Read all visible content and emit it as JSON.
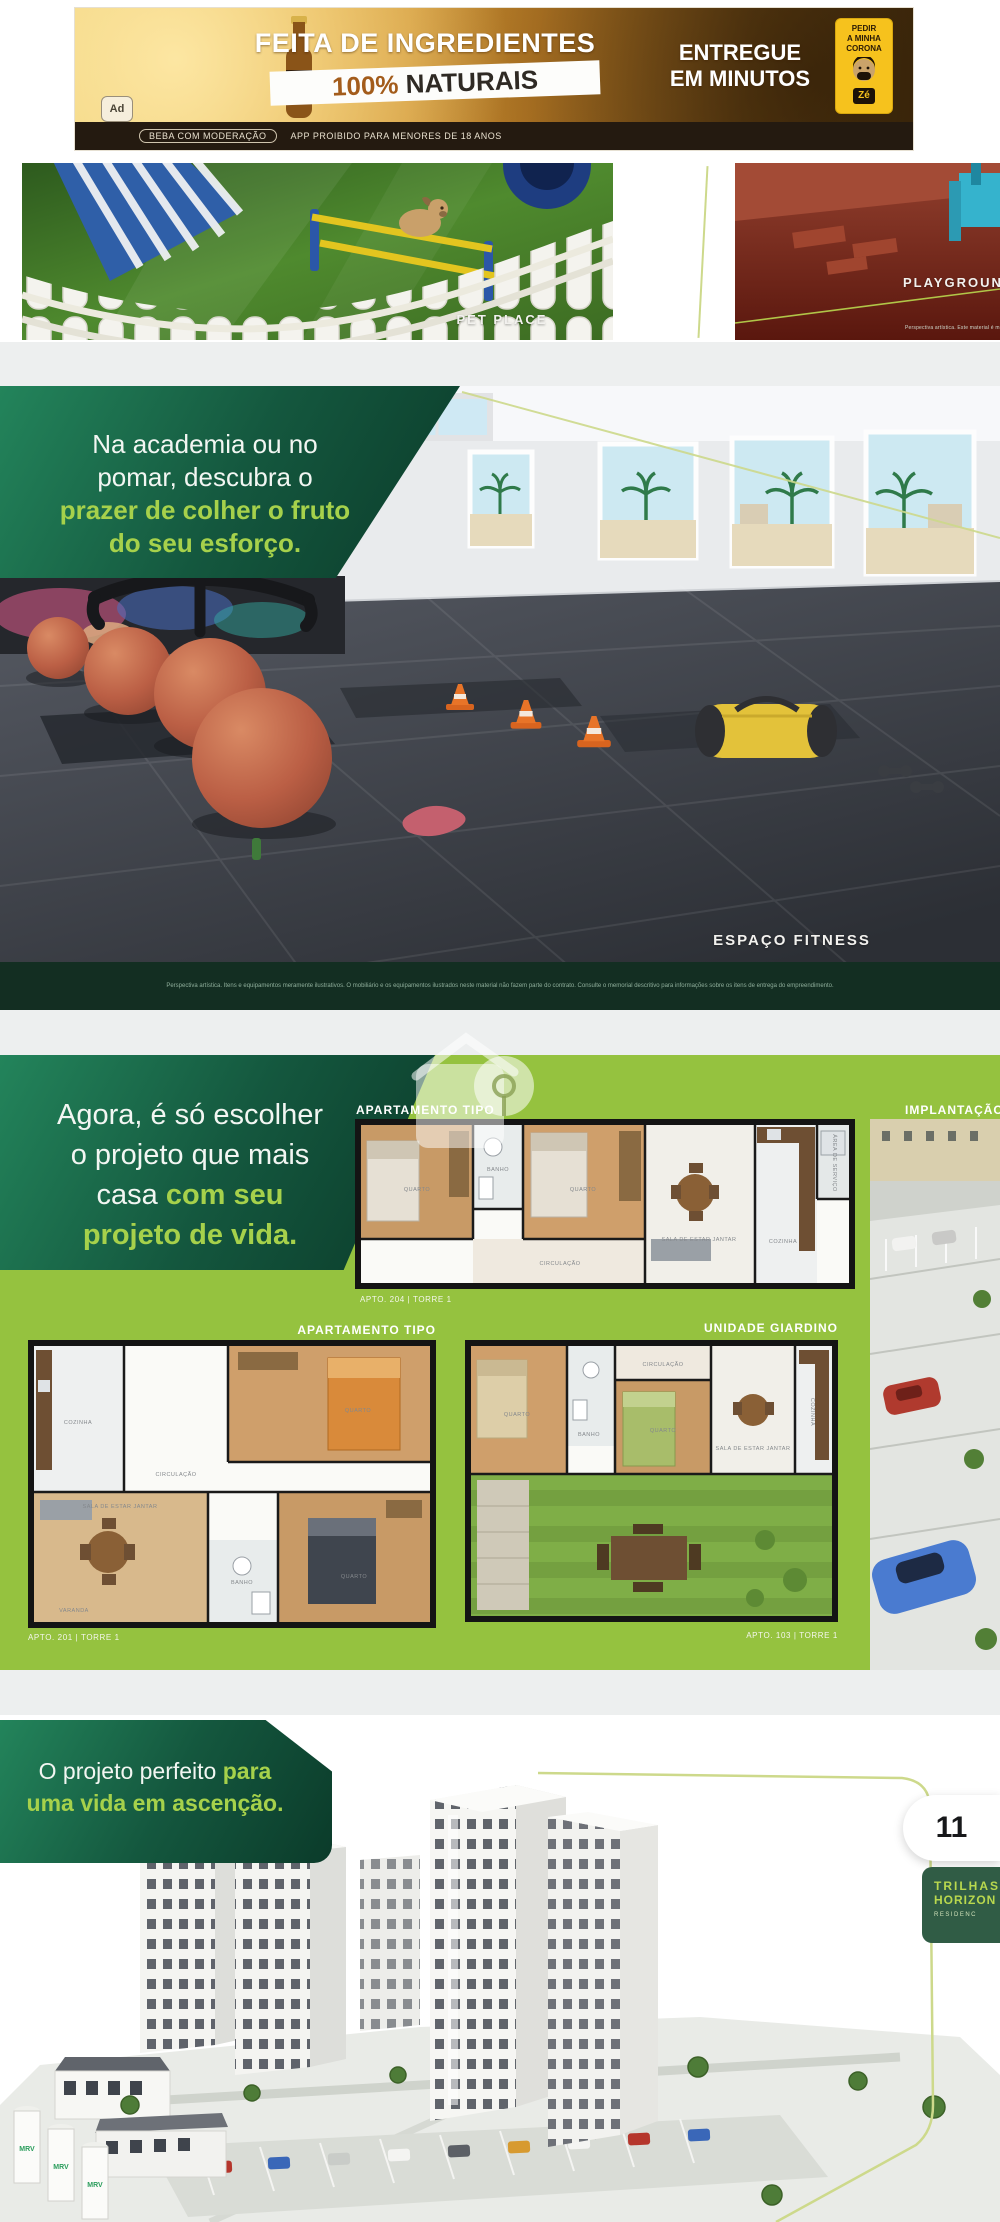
{
  "ad": {
    "headline": "FEITA DE INGREDIENTES",
    "highlight_pct": "100%",
    "highlight_rest": " NATURAIS",
    "delivery_l1": "ENTREGUE",
    "delivery_l2": "EM MINUTOS",
    "cta_l1": "PEDIR",
    "cta_l2": "A MINHA",
    "cta_l3": "CORONA",
    "brand": "Zé",
    "ad_badge": "Ad",
    "disclaimer_pill": "BEBA COM MODERAÇÃO",
    "disclaimer_text": "APP PROIBIDO PARA MENORES DE 18 ANOS"
  },
  "amenities": {
    "pet_label": "PET PLACE",
    "playground_label": "PLAYGROUND",
    "playground_note": "Perspectiva artística. Este material é meramente ilustrativo."
  },
  "fitness": {
    "headline_l1": "Na academia ou no",
    "headline_l2": "pomar, descubra o",
    "headline_l3": "prazer de colher o fruto",
    "headline_l4": "do seu esforço.",
    "label": "ESPAÇO FITNESS",
    "note": "Perspectiva artística. Itens e equipamentos meramente ilustrativos. O mobiliário e os equipamentos ilustrados neste material não fazem parte do contrato. Consulte o memorial descritivo para informações sobre os itens de entrega do empreendimento."
  },
  "plans": {
    "headline_l1": "Agora, é só escolher",
    "headline_l2": "o projeto que mais",
    "headline_l3a": "casa ",
    "headline_l3b": "com seu",
    "headline_l4": "projeto de vida.",
    "implant_label": "IMPLANTAÇÃO",
    "plan1": {
      "label": "APARTAMENTO TIPO",
      "caption": "APTO. 204 | TORRE 1",
      "rooms": [
        "QUARTO",
        "BANHO",
        "QUARTO",
        "SALA DE ESTAR JANTAR",
        "CIRCULAÇÃO",
        "COZINHA",
        "ÁREA DE SERVIÇO"
      ]
    },
    "plan2": {
      "label": "APARTAMENTO TIPO",
      "caption": "APTO. 201 | TORRE 1",
      "rooms": [
        "COZINHA",
        "QUARTO",
        "CIRCULAÇÃO",
        "SALA DE ESTAR JANTAR",
        "BANHO",
        "QUARTO",
        "VARANDA"
      ]
    },
    "plan3": {
      "label": "UNIDADE GIARDINO",
      "caption": "APTO. 103 | TORRE 1",
      "rooms": [
        "QUARTO",
        "BANHO",
        "QUARTO",
        "SALA DE ESTAR JANTAR",
        "COZINHA",
        "CIRCULAÇÃO"
      ]
    }
  },
  "hero": {
    "headline_l1a": "O projeto perfeito ",
    "headline_l1b": "para",
    "headline_l2": "uma vida em ascenção.",
    "page_number": "11",
    "badge_l1": "TRILHAS",
    "badge_l2": "HORIZON",
    "badge_l3": "RESIDENC",
    "tank_label": "MRV"
  }
}
